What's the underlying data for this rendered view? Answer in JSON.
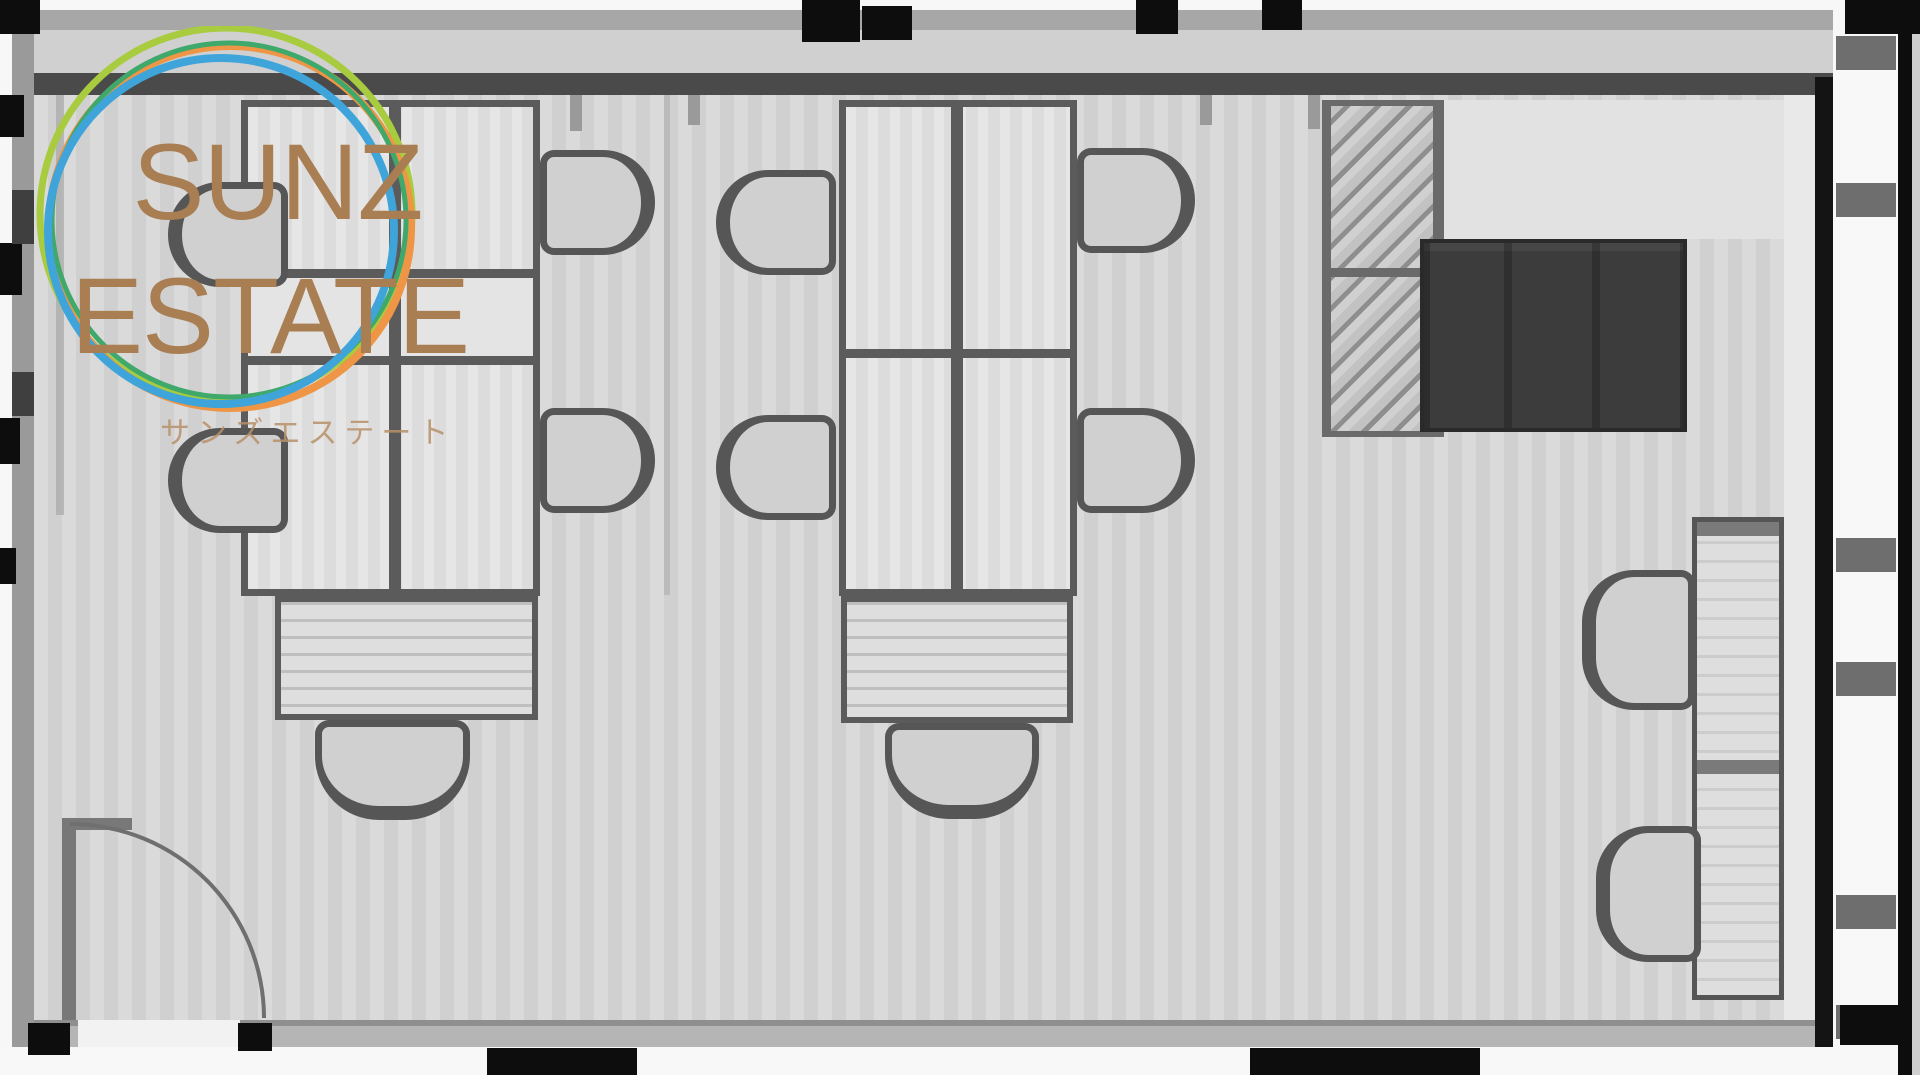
{
  "logo": {
    "title_line1": "SUNZ",
    "title_line2": "ESTATE",
    "subtitle": "サンズエステート"
  },
  "colors": {
    "brand_text": "#a87e52",
    "brand_subtext": "#b8916a",
    "ring_orange": "#ef9546",
    "ring_blue": "#3ea4da",
    "ring_green": "#3fa86b",
    "ring_lime": "#a8cb3f",
    "wall_dark": "#4a4a4a",
    "wall_black": "#0d0d0d",
    "floor": "#d4d4d4",
    "furniture_fill": "#dcdcdc",
    "furniture_line": "#5b5b5b",
    "dark_box": "#3c3c3c",
    "outer_white": "#f7f7f7"
  }
}
